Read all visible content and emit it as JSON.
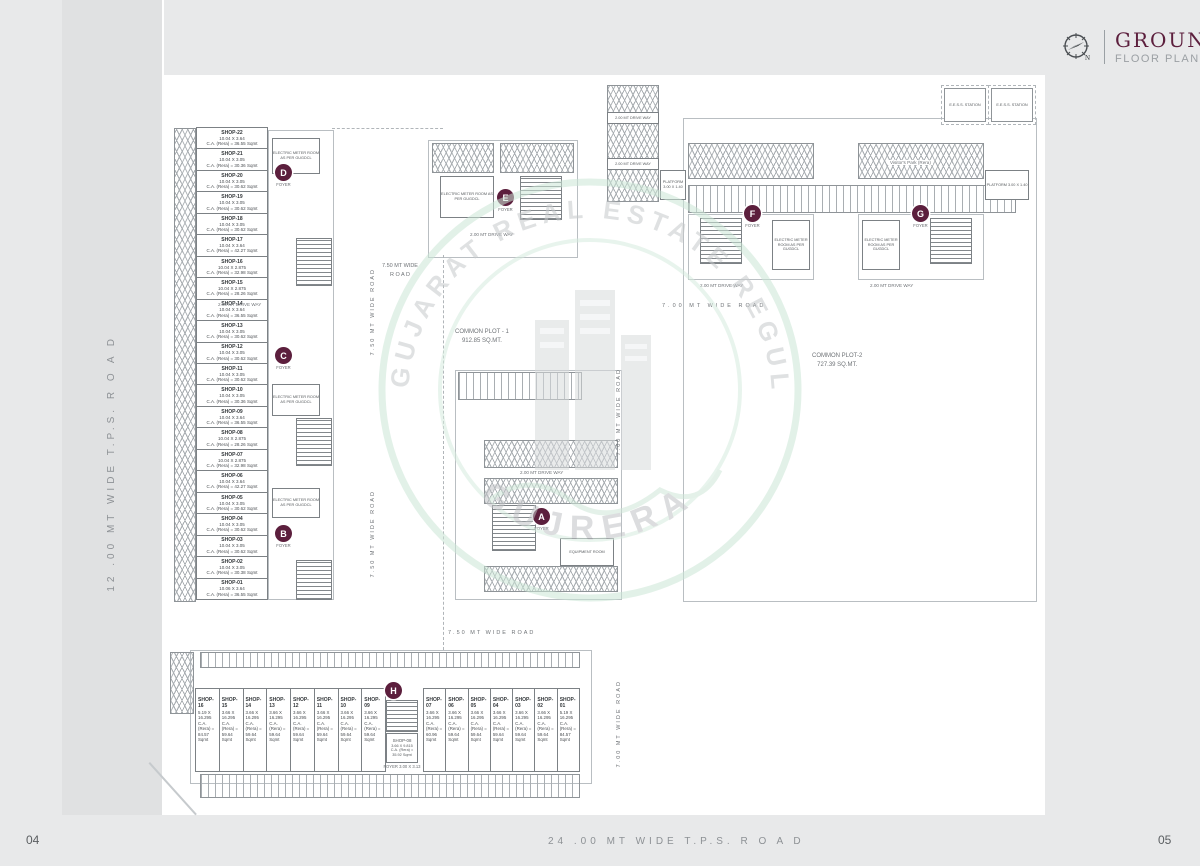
{
  "header": {
    "title": "GROUND",
    "subtitle": "FLOOR PLAN"
  },
  "page": {
    "left_number": "04",
    "right_number": "05"
  },
  "roads": {
    "left_vertical": "12 .00 MT WIDE T.P.S. R O A D",
    "bottom_horizontal": "24 .00 MT WIDE T.P.S. R O A D",
    "wide_750": "7.50 MT WIDE ROAD",
    "wide_750_2line_top": "7.50 MT WIDE",
    "wide_750_2line_bottom": "R O A D",
    "wide_700": "7.00 MT WIDE ROAD",
    "drive_way": "2.00 MT DRIVE WAY"
  },
  "watermark": {
    "arc_text": "GUJARAT REAL ESTATE REGULATORY AUTHORITY",
    "name": "GUJRERA"
  },
  "markers": {
    "a": "A",
    "b": "B",
    "c": "C",
    "d": "D",
    "e": "E",
    "f": "F",
    "g": "G",
    "h": "H"
  },
  "labels": {
    "foyer": "FOYER",
    "foyer_h": "FOYER 3.00 X 3.13",
    "common_plot_1_name": "COMMON PLOT - 1",
    "common_plot_1_area": "912.85 SQ.MT.",
    "common_plot_2_name": "COMMON PLOT-2",
    "common_plot_2_area": "727.39 SQ.MT.",
    "visitors_park": "Visitor's Park (Rera)",
    "platform": "PLATFORM 3.00 X 1.40",
    "eess": "E.E.S.S. STATION",
    "electric_room": "ELECTRIC METER ROOM AS PER GUGDCL",
    "equipment": "EQUIPMENT ROOM"
  },
  "left_shops": [
    {
      "name": "SHOP-22",
      "size": "10.04 X 3.64",
      "rera": "C.A. (Rera) = 36.55 Sqmt"
    },
    {
      "name": "SHOP-21",
      "size": "10.04 X 3.05",
      "rera": "C.A. (Rera) = 30.36 Sqmt"
    },
    {
      "name": "SHOP-20",
      "size": "10.04 X 3.05",
      "rera": "C.A. (Rera) = 30.62 Sqmt"
    },
    {
      "name": "SHOP-19",
      "size": "10.04 X 3.05",
      "rera": "C.A. (Rera) = 30.62 Sqmt"
    },
    {
      "name": "SHOP-18",
      "size": "10.04 X 3.05",
      "rera": "C.A. (Rera) = 30.62 Sqmt"
    },
    {
      "name": "SHOP-17",
      "size": "10.04 X 3.64",
      "rera": "C.A. (Rera) = 42.27 Sqmt"
    },
    {
      "name": "SHOP-16",
      "size": "10.04 X 2.875",
      "rera": "C.A. (Rera) = 32.98 Sqmt"
    },
    {
      "name": "SHOP-15",
      "size": "10.04 X 2.875",
      "rera": "C.A. (Rera) = 28.26 Sqmt"
    },
    {
      "name": "SHOP-14",
      "size": "10.04 X 3.64",
      "rera": "C.A. (Rera) = 36.55 Sqmt"
    },
    {
      "name": "SHOP-13",
      "size": "10.04 X 3.05",
      "rera": "C.A. (Rera) = 30.62 Sqmt"
    },
    {
      "name": "SHOP-12",
      "size": "10.04 X 3.05",
      "rera": "C.A. (Rera) = 30.62 Sqmt"
    },
    {
      "name": "SHOP-11",
      "size": "10.04 X 3.05",
      "rera": "C.A. (Rera) = 30.62 Sqmt"
    },
    {
      "name": "SHOP-10",
      "size": "10.04 X 3.05",
      "rera": "C.A. (Rera) = 30.36 Sqmt"
    },
    {
      "name": "SHOP-09",
      "size": "10.04 X 3.64",
      "rera": "C.A. (Rera) = 36.55 Sqmt"
    },
    {
      "name": "SHOP-08",
      "size": "10.04 X 2.875",
      "rera": "C.A. (Rera) = 28.26 Sqmt"
    },
    {
      "name": "SHOP-07",
      "size": "10.04 X 2.875",
      "rera": "C.A. (Rera) = 32.98 Sqmt"
    },
    {
      "name": "SHOP-06",
      "size": "10.04 X 3.64",
      "rera": "C.A. (Rera) = 42.27 Sqmt"
    },
    {
      "name": "SHOP-05",
      "size": "10.04 X 3.05",
      "rera": "C.A. (Rera) = 30.62 Sqmt"
    },
    {
      "name": "SHOP-04",
      "size": "10.04 X 3.05",
      "rera": "C.A. (Rera) = 30.62 Sqmt"
    },
    {
      "name": "SHOP-03",
      "size": "10.04 X 3.05",
      "rera": "C.A. (Rera) = 30.62 Sqmt"
    },
    {
      "name": "SHOP-02",
      "size": "10.04 X 3.05",
      "rera": "C.A. (Rera) = 30.38 Sqmt"
    },
    {
      "name": "SHOP-01",
      "size": "10.06 X 3.64",
      "rera": "C.A. (Rera) = 36.55 Sqmt"
    }
  ],
  "bottom_shops_left": [
    {
      "name": "SHOP-16",
      "size": "5.19 X 16.295",
      "rera": "C.A. (Rera) =",
      "area": "84.57 Sqmt"
    },
    {
      "name": "SHOP-15",
      "size": "3.66 X 16.295",
      "rera": "C.A. (Rera) =",
      "area": "59.64 Sqmt"
    },
    {
      "name": "SHOP-14",
      "size": "3.66 X 16.295",
      "rera": "C.A. (Rera) =",
      "area": "59.64 Sqmt"
    },
    {
      "name": "SHOP-13",
      "size": "3.66 X 16.295",
      "rera": "C.A. (Rera) =",
      "area": "59.64 Sqmt"
    },
    {
      "name": "SHOP-12",
      "size": "3.66 X 16.295",
      "rera": "C.A. (Rera) =",
      "area": "59.64 Sqmt"
    },
    {
      "name": "SHOP-11",
      "size": "3.66 X 16.295",
      "rera": "C.A. (Rera) =",
      "area": "59.64 Sqmt"
    },
    {
      "name": "SHOP-10",
      "size": "3.66 X 16.295",
      "rera": "C.A. (Rera) =",
      "area": "59.64 Sqmt"
    },
    {
      "name": "SHOP-09",
      "size": "3.66 X 16.295",
      "rera": "C.A. (Rera) =",
      "area": "59.64 Sqmt"
    }
  ],
  "bottom_shops_right": [
    {
      "name": "SHOP-07",
      "size": "3.66 X 16.295",
      "rera": "C.A. (Rera) =",
      "area": "60.96 Sqmt"
    },
    {
      "name": "SHOP-06",
      "size": "3.66 X 16.295",
      "rera": "C.A. (Rera) =",
      "area": "59.64 Sqmt"
    },
    {
      "name": "SHOP-05",
      "size": "3.66 X 16.295",
      "rera": "C.A. (Rera) =",
      "area": "59.64 Sqmt"
    },
    {
      "name": "SHOP-04",
      "size": "3.66 X 16.295",
      "rera": "C.A. (Rera) =",
      "area": "59.64 Sqmt"
    },
    {
      "name": "SHOP-03",
      "size": "3.66 X 16.295",
      "rera": "C.A. (Rera) =",
      "area": "59.64 Sqmt"
    },
    {
      "name": "SHOP-02",
      "size": "3.66 X 16.295",
      "rera": "C.A. (Rera) =",
      "area": "59.64 Sqmt"
    },
    {
      "name": "SHOP-01",
      "size": "5.19 X 16.295",
      "rera": "C.A. (Rera) =",
      "area": "84.57 Sqmt"
    }
  ],
  "shop08_bottom": {
    "name": "SHOP-08",
    "size": "3.66 X 9.815",
    "rera": "C.A. (Rera) =",
    "area": "35.92 Sqmt"
  }
}
